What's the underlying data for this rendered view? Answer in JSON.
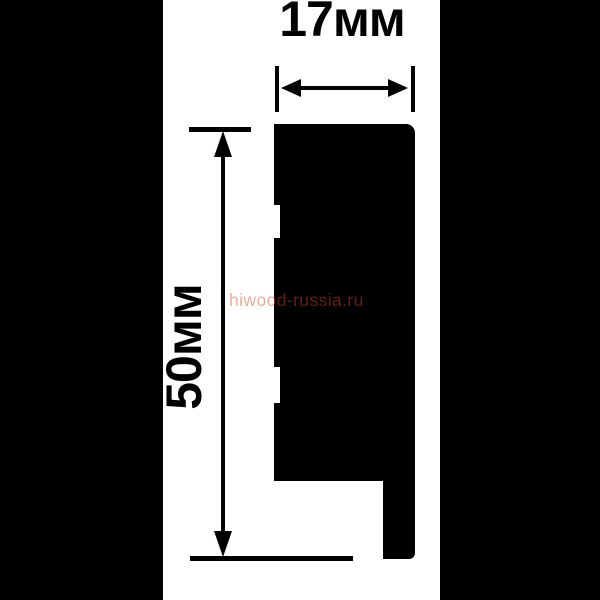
{
  "figure": {
    "type": "technical-drawing",
    "subject": "moulding profile cross-section with dimensions",
    "width_label": "17мм",
    "height_label": "50мм",
    "watermark": "hiwood-russia.ru",
    "colors": {
      "ink": "#000000",
      "background": "#ffffff",
      "letterbox": "#000000",
      "watermark": "rgba(222,70,20,0.45)"
    }
  }
}
